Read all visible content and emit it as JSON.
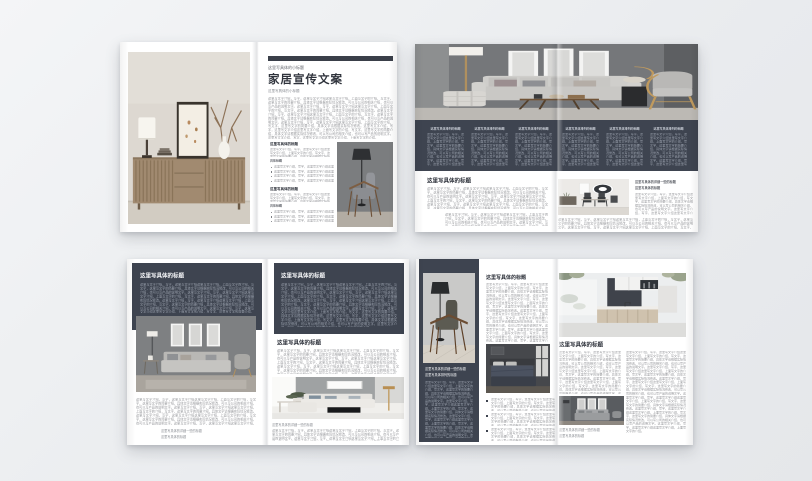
{
  "backdrop": {
    "bg_top": "#f4f5f7",
    "bg_bottom": "#e5e7ea"
  },
  "colors": {
    "panel_dark": "#3e4450",
    "page_white": "#ffffff",
    "accent_bar": "#3a3f49",
    "heading_dark": "#2e323b",
    "heading_white": "#f5f6f8",
    "body_gray": "#97989c",
    "body_light": "#9aa1ad"
  },
  "placeholders": {
    "small_title": "这里写具体的小标题",
    "main_title": "家居宣传文案",
    "section_title": "这里写具体的标题",
    "column_title": "这里写具体排列的标题",
    "caption_detail": "这里写具体的详细一些的标题",
    "caption_short": "这里写具体的标题",
    "caption_second": "这里写具体排列的标题",
    "sub_heading": "具体标题",
    "bullet_line": "这里写文字介绍，写字，这里写文字介绍这里写文字介绍。",
    "body_s": "这里写文字介绍，写字，这里写文字介绍这里写文字介绍，上面写文字的介绍，写文字，这里写文字的简要介绍，具体文字请根据实际情况修改，可以写公司的相关介绍，也可以写产品的说明文字。",
    "body_m": "这里写文字介绍，写字，这里写文字介绍这里写文字介绍，上面写文字的介绍，写文字，这里写文字的简要介绍，具体文字请根据实际情况修改，可以写公司的相关介绍，也可以写产品的说明文字。这里写文字介绍，写字，这里写文字介绍这里写文字介绍，上面写文字的介绍，写文字，这里写文字的简要介绍，具体文字请根据实际情况修改。这里写文字介绍，写字，这里写文字介绍这里写文字介绍，上面写文字的介绍。",
    "body_l": "这里写文字介绍，写字，这里写文字介绍这里写文字介绍，上面写文字的介绍，写文字，这里写文字的简要介绍，具体文字请根据实际情况修改，可以写公司的相关介绍，也可以写产品的说明文字。这里写文字介绍，写字，这里写文字介绍这里写文字介绍，上面写文字的介绍，写文字，这里写文字的简要介绍，具体文字请根据实际情况修改。这里写文字介绍，写字，这里写文字介绍这里写文字介绍，上面写文字的介绍，写文字，这里写文字的简要介绍，具体文字请根据实际情况修改，可以写公司的相关介绍，也可以写产品的说明文字。这里写文字介绍，写字，这里写文字介绍这里写文字介绍，上面写文字的介绍，写文字，这里写文字的简要介绍。",
    "body_xl": "这里写文字介绍，写字，这里写文字介绍这里写文字介绍，上面写文字的介绍，写文字，这里写文字的简要介绍，具体文字请根据实际情况修改，可以写公司的相关介绍，也可以写产品的说明文字。这里写文字介绍，写字，这里写文字介绍这里写文字介绍，上面写文字的介绍，写文字，这里写文字的简要介绍，具体文字请根据实际情况修改。这里写文字介绍，写字，这里写文字介绍这里写文字介绍，上面写文字的介绍，写文字，这里写文字的简要介绍，具体文字请根据实际情况修改，可以写公司的相关介绍，也可以写产品的说明文字。这里写文字介绍，写字，这里写文字介绍这里写文字介绍，上面写文字的介绍，写文字，这里写文字的简要介绍，具体文字请根据实际情况修改。这里写文字介绍，写字，这里写文字介绍这里写文字介绍，上面写文字的介绍，写文字，这里写文字的简要介绍，具体文字请根据实际情况修改，可以写公司的相关介绍，也可以写产品的说明文字。这里写文字介绍，写字，这里写文字介绍这里写文字介绍，上面写文字的介绍。"
  },
  "photos": {
    "sideboard": "wooden-sideboard-still-life",
    "hero_livingroom": "gray-livingroom-sofa-wide",
    "armchair_lamp": "armchair-with-floor-lamp",
    "dining": "dining-room-round-art",
    "livingroom_gray": "gray-wall-sofa-triptych",
    "sofa_white": "white-sectional-sofa-room",
    "armchair_wood": "wood-armchair-black-lamp",
    "bedroom": "dark-bedroom",
    "kitchen": "white-kitchen-island",
    "sofa_gray": "gray-sofa-dark-wall"
  }
}
